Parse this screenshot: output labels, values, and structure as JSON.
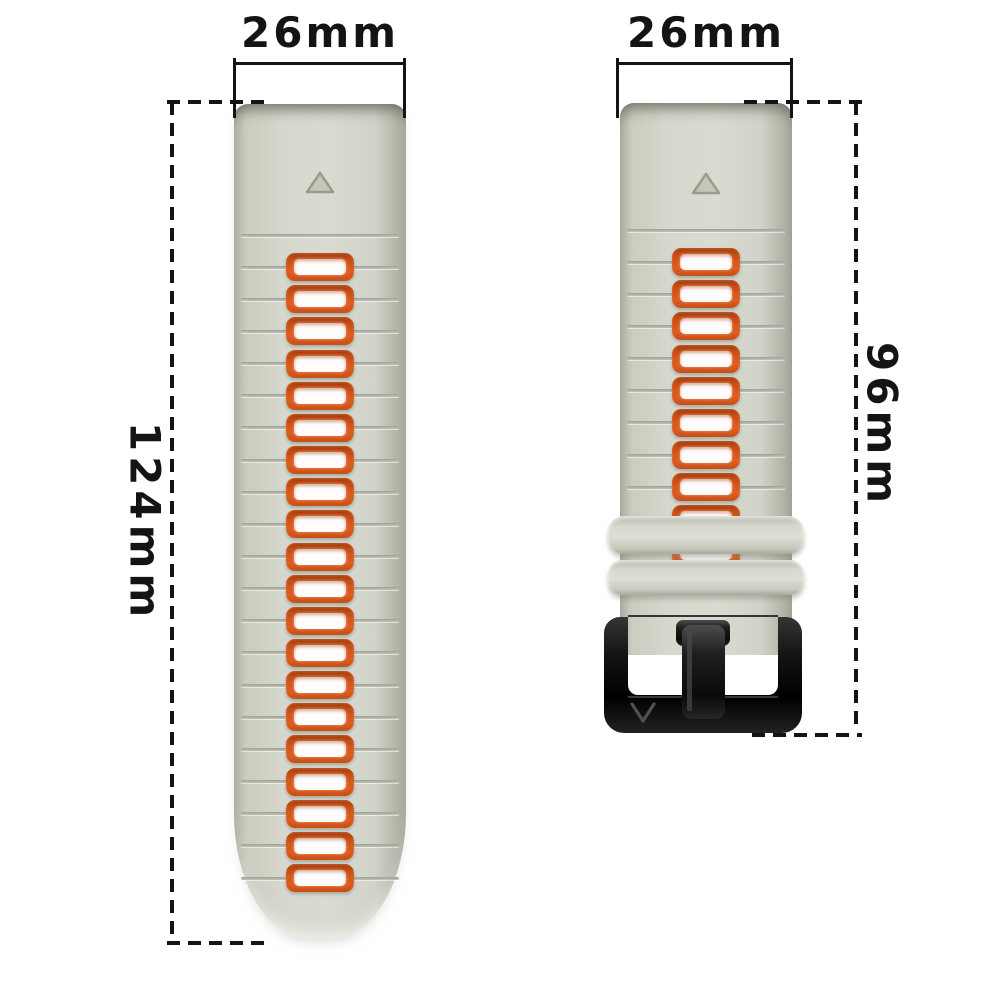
{
  "image": {
    "description": "Two-piece silicone watch band (gray with orange inner holes) shown with dimension annotations on white background",
    "background_color": "#ffffff"
  },
  "annotations": {
    "left_band_width": "26mm",
    "right_band_width": "26mm",
    "left_band_length": "124mm",
    "right_band_length": "96mm"
  },
  "colors": {
    "strap_gray": "#d5d6cb",
    "strap_edge_gray": "#a7a89c",
    "hole_orange": "#d2531d",
    "hole_inner_white": "#fffdfb",
    "buckle_black": "#141414",
    "annotation_line": "#141414"
  },
  "bands": {
    "left": {
      "name": "long strap with holes",
      "rows": 21,
      "holes": 20,
      "marker": "triangle"
    },
    "right": {
      "name": "short strap with buckle",
      "rows": 11,
      "holes": 10,
      "keepers": 2,
      "buckle_logo_mark": "V",
      "marker": "triangle"
    }
  }
}
